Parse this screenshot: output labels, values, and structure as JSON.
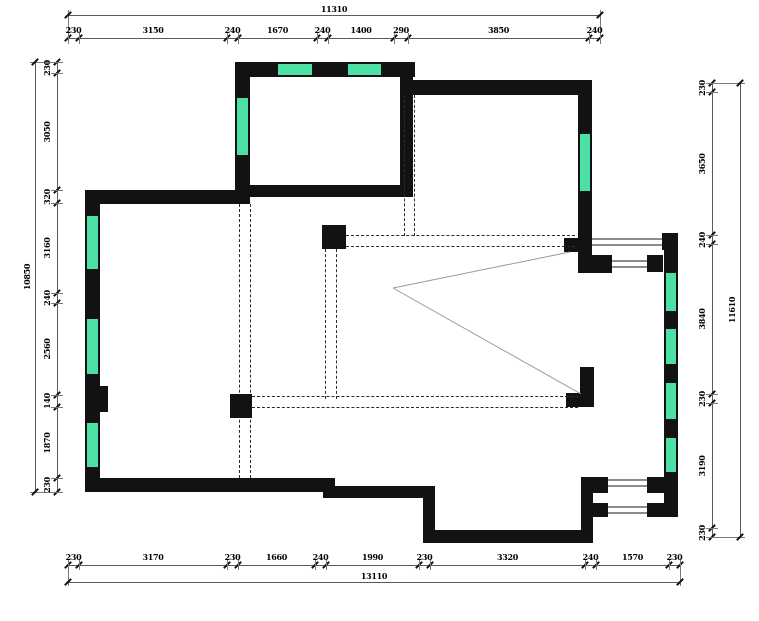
{
  "drawing": {
    "kind": "floor-plan"
  },
  "colors": {
    "wall": "#121212",
    "window": "#4de0a4",
    "railing": "#8c8c8c",
    "dashed": "#2b2b2b",
    "dimension": "#5a5a5a"
  },
  "dimensions": {
    "top": {
      "overall": "11310",
      "segments": [
        "230",
        "3150",
        "240",
        "1670",
        "240",
        "1400",
        "290",
        "3850",
        "240"
      ]
    },
    "bottom": {
      "overall": "13110",
      "segments": [
        "230",
        "3170",
        "230",
        "1660",
        "240",
        "1990",
        "230",
        "3320",
        "240",
        "1570",
        "230"
      ]
    },
    "left": {
      "overall": "10850",
      "segments": [
        "230",
        "3050",
        "320",
        "3160",
        "240",
        "2560",
        "140",
        "1870",
        "230"
      ]
    },
    "right": {
      "overall": "11610",
      "segments": [
        "230",
        "3650",
        "240",
        "3840",
        "230",
        "3190",
        "230"
      ]
    }
  }
}
